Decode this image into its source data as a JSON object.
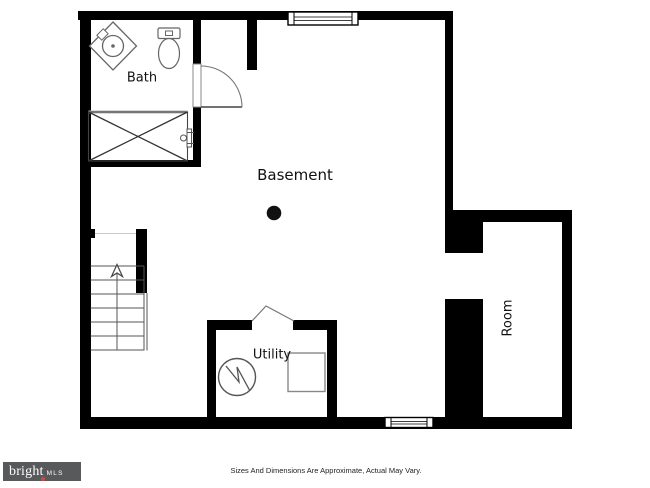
{
  "floorplan": {
    "rooms": {
      "bath": {
        "label": "Bath"
      },
      "basement": {
        "label": "Basement"
      },
      "utility": {
        "label": "Utility"
      },
      "room": {
        "label": "Room"
      }
    },
    "fixtures": {
      "sink": "corner-sink",
      "toilet": "toilet",
      "shower": "shower-with-x-brace",
      "water_heater": "water-heater-circle",
      "furnace": "furnace-square",
      "stairs": {
        "direction": "up",
        "treads": 7
      },
      "column": "support-column-dot",
      "windows": 2,
      "doors": [
        "bath-swing-door",
        "utility-opening-peak"
      ]
    },
    "colors": {
      "wall": "#000000",
      "fixture_outline": "#666666",
      "shower_glass": "#b3b3b3"
    }
  },
  "footer": {
    "disclaimer": "Sizes And Dimensions Are Approximate, Actual May Vary.",
    "logo": {
      "brand": "bright",
      "suffix": "MLS",
      "background": "#58595b",
      "accent": "#cf4a3c",
      "text_color": "#ffffff"
    }
  }
}
